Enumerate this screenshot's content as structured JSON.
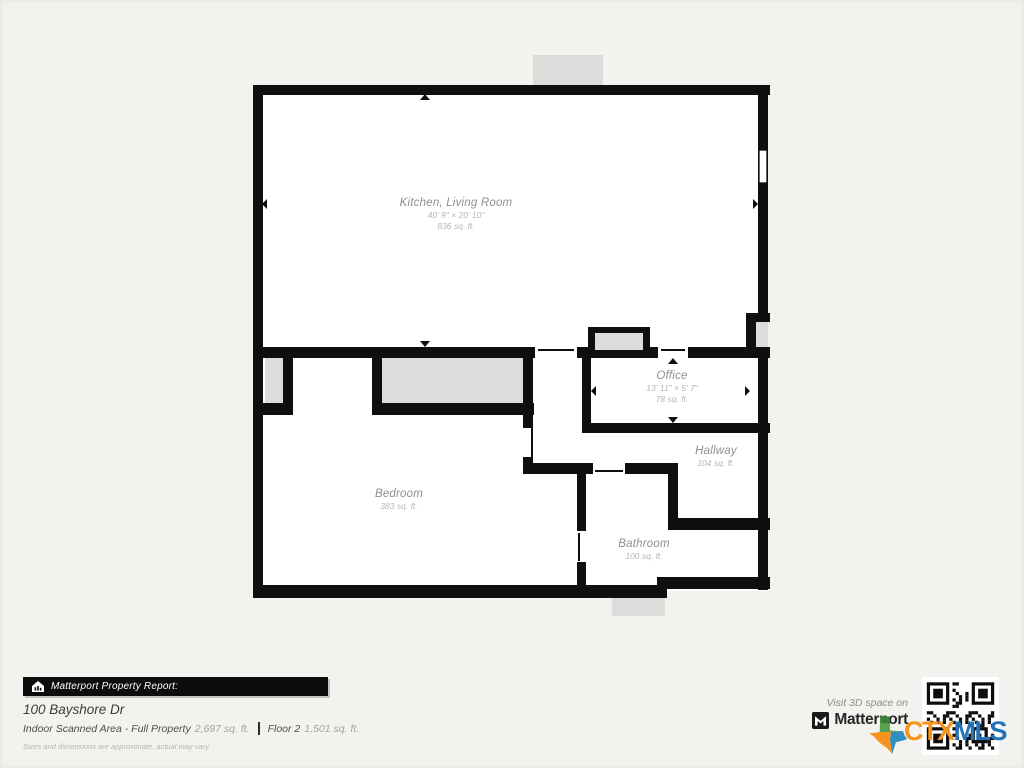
{
  "colors": {
    "wall": "#0f0f0f",
    "room_fill": "#ffffff",
    "porch_fill": "#dcdcda",
    "page_background": "#f4f2ef",
    "label": "#8f8f8f",
    "ctx_orange": "#f7941e",
    "mls_blue": "#2273b8"
  },
  "floorplan": {
    "rooms": {
      "kitchen_living": {
        "name": "Kitchen, Living Room",
        "dims": "40' 9\" × 20' 10\"",
        "area": "836 sq. ft."
      },
      "office": {
        "name": "Office",
        "dims": "13' 11\" × 5' 7\"",
        "area": "78 sq. ft."
      },
      "hallway": {
        "name": "Hallway",
        "area": "104 sq. ft."
      },
      "bedroom": {
        "name": "Bedroom",
        "area": "383 sq. ft."
      },
      "bathroom": {
        "name": "Bathroom",
        "area": "100 sq. ft."
      }
    }
  },
  "footer": {
    "report_bar_label": "Matterport Property Report:",
    "address": "100 Bayshore Dr",
    "scanned_area_label": "Indoor Scanned Area - Full Property",
    "scanned_area_value": "2,697 sq. ft.",
    "floor_label": "Floor 2",
    "floor_value": "1,501 sq. ft.",
    "disclaimer": "Sizes and dimensions are approximate, actual may vary.",
    "visit_text": "Visit 3D space on",
    "matterport_wordmark": "Matterport",
    "ctx": "CTX",
    "mls": "MLS"
  }
}
